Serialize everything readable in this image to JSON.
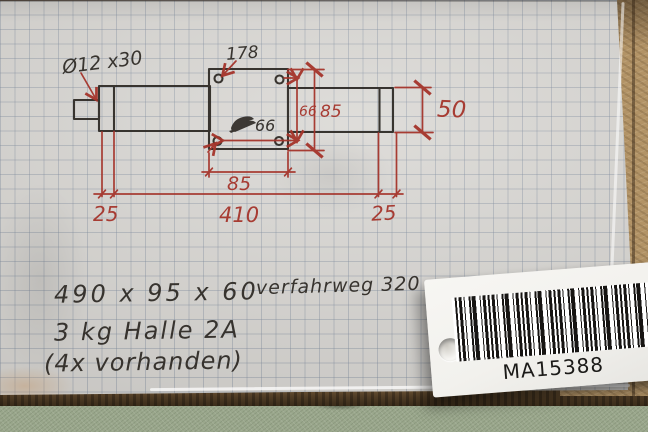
{
  "colors": {
    "ink_black": "#2b2722",
    "ink_red": "#a5342b",
    "paper": "#d8d6d2",
    "table_tan": "#b29366",
    "table_green": "#9aa78c",
    "edge_brown": "#503d26",
    "card_white": "#f2f1ed",
    "barcode_black": "#171513"
  },
  "drawing": {
    "dimensions": {
      "stub": "Ø12 x30",
      "block_top": "178",
      "hole_spacing_inner": "66",
      "hole_spacing_right": "66",
      "block_height": "85",
      "block_width": "85",
      "right_end_height": "50",
      "flange_left": "25",
      "body_length": "410",
      "flange_right": "25"
    }
  },
  "notes": {
    "outer_dimensions": "490 x 95 x 60",
    "travel": "verfahrweg 320",
    "weight_hall": "3 kg  Halle 2A",
    "quantity": "(4x vorhanden)"
  },
  "tag": {
    "code": "MA15388"
  }
}
